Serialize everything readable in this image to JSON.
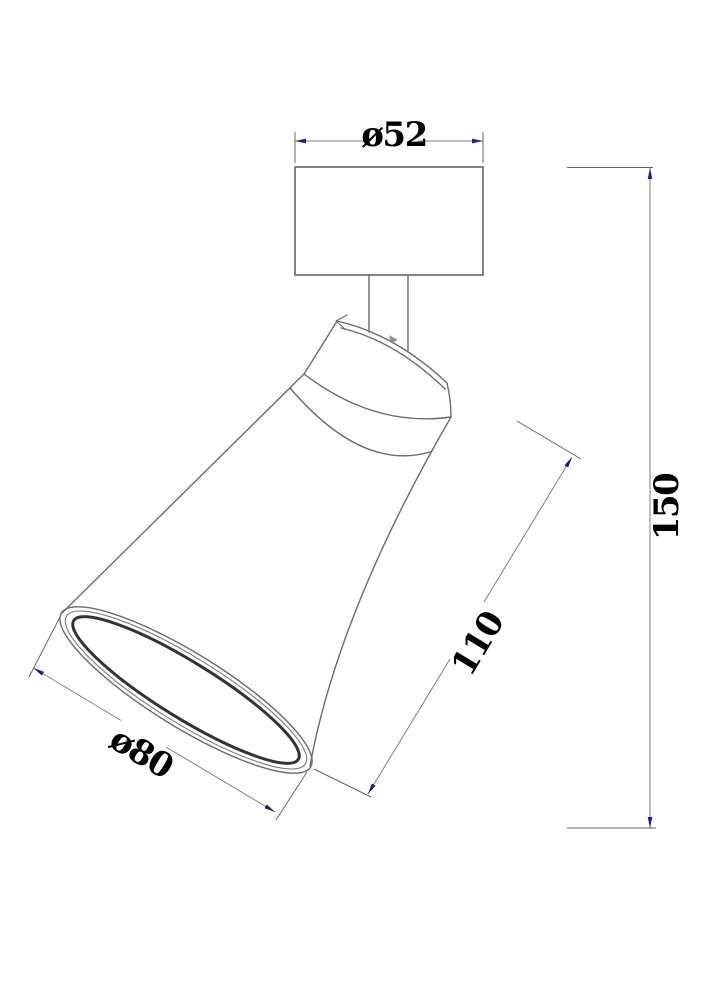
{
  "page": {
    "background": "#ffffff",
    "description": "Technical dimension drawing of an adjustable ceiling spotlight with a cylindrical canopy, short stem and tilted conical shade"
  },
  "drawing": {
    "object": "adjustable spotlight fixture",
    "view": "side view with shade tilted down-left",
    "colors": {
      "outline": "#6b6b6b",
      "extension_lines": "#646464",
      "dimension_lines": "#7d7d7d",
      "arrows": "#1d1d8f",
      "text": "#000000",
      "rim_accent": "#333333"
    },
    "dimensions": {
      "canopy_diameter": {
        "label": "ø52",
        "value": 52,
        "kind": "diameter",
        "location": "top canopy width"
      },
      "shade_opening": {
        "label": "ø80",
        "value": 80,
        "kind": "diameter",
        "location": "shade front opening"
      },
      "shade_length": {
        "label": "110",
        "value": 110,
        "kind": "linear",
        "location": "shade slant length"
      },
      "overall_height": {
        "label": "150",
        "value": 150,
        "kind": "linear",
        "location": "overall height, right side"
      }
    }
  }
}
